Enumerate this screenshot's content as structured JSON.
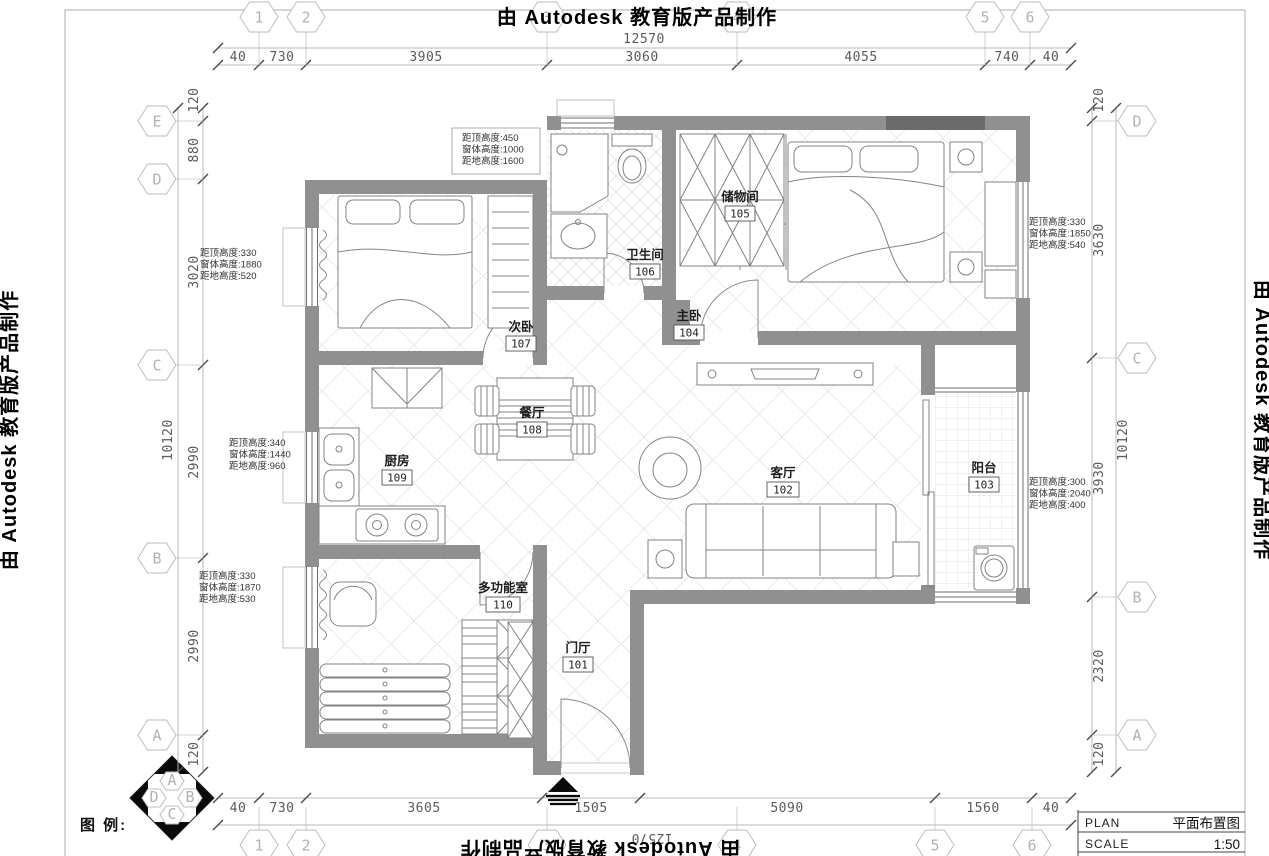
{
  "watermark": "由 Autodesk 教育版产品制作",
  "dims": {
    "top": {
      "total": "12570",
      "segments": [
        "40",
        "730",
        "3905",
        "3060",
        "4055",
        "740",
        "40"
      ]
    },
    "bottom": {
      "total": "12570",
      "segments": [
        "40",
        "730",
        "3605",
        "1505",
        "5090",
        "1560",
        "40"
      ]
    },
    "left": {
      "total": "10120",
      "segments": [
        "120",
        "880",
        "3020",
        "2990",
        "2990",
        "120"
      ]
    },
    "right": {
      "total": "10120",
      "segments": [
        "120",
        "3630",
        "3930",
        "2320",
        "120"
      ]
    }
  },
  "grid": {
    "top": [
      "1",
      "2",
      "3",
      "4",
      "5",
      "6"
    ],
    "bottom": [
      "1",
      "2",
      "3",
      "4",
      "5",
      "6"
    ],
    "left": [
      "E",
      "D",
      "C",
      "B",
      "A"
    ],
    "right": [
      "D",
      "C",
      "B",
      "A"
    ],
    "compass": [
      "A",
      "B",
      "C",
      "D"
    ]
  },
  "rooms": [
    {
      "name": "门厅",
      "number": "101"
    },
    {
      "name": "客厅",
      "number": "102"
    },
    {
      "name": "阳台",
      "number": "103"
    },
    {
      "name": "主卧",
      "number": "104"
    },
    {
      "name": "储物间",
      "number": "105"
    },
    {
      "name": "卫生间",
      "number": "106"
    },
    {
      "name": "次卧",
      "number": "107"
    },
    {
      "name": "餐厅",
      "number": "108"
    },
    {
      "name": "厨房",
      "number": "109"
    },
    {
      "name": "多功能室",
      "number": "110"
    }
  ],
  "annotations": [
    {
      "lines": [
        "距顶高度:450",
        "窗体高度:1000",
        "距地高度:1600"
      ]
    },
    {
      "lines": [
        "距顶高度:330",
        "窗体高度:1880",
        "距地高度:520"
      ]
    },
    {
      "lines": [
        "距顶高度:340",
        "窗体高度:1440",
        "距地高度:960"
      ]
    },
    {
      "lines": [
        "距顶高度:330",
        "窗体高度:1870",
        "距地高度:530"
      ]
    },
    {
      "lines": [
        "距顶高度:330",
        "窗体高度:1850",
        "距地高度:540"
      ]
    },
    {
      "lines": [
        "距顶高度:300",
        "窗体高度:2040",
        "距地高度:400"
      ]
    }
  ],
  "legend_label": "图 例:",
  "title_block": {
    "plan_label": "PLAN",
    "plan_value": "平面布置图",
    "scale_label": "SCALE",
    "scale_value": "1:50"
  }
}
